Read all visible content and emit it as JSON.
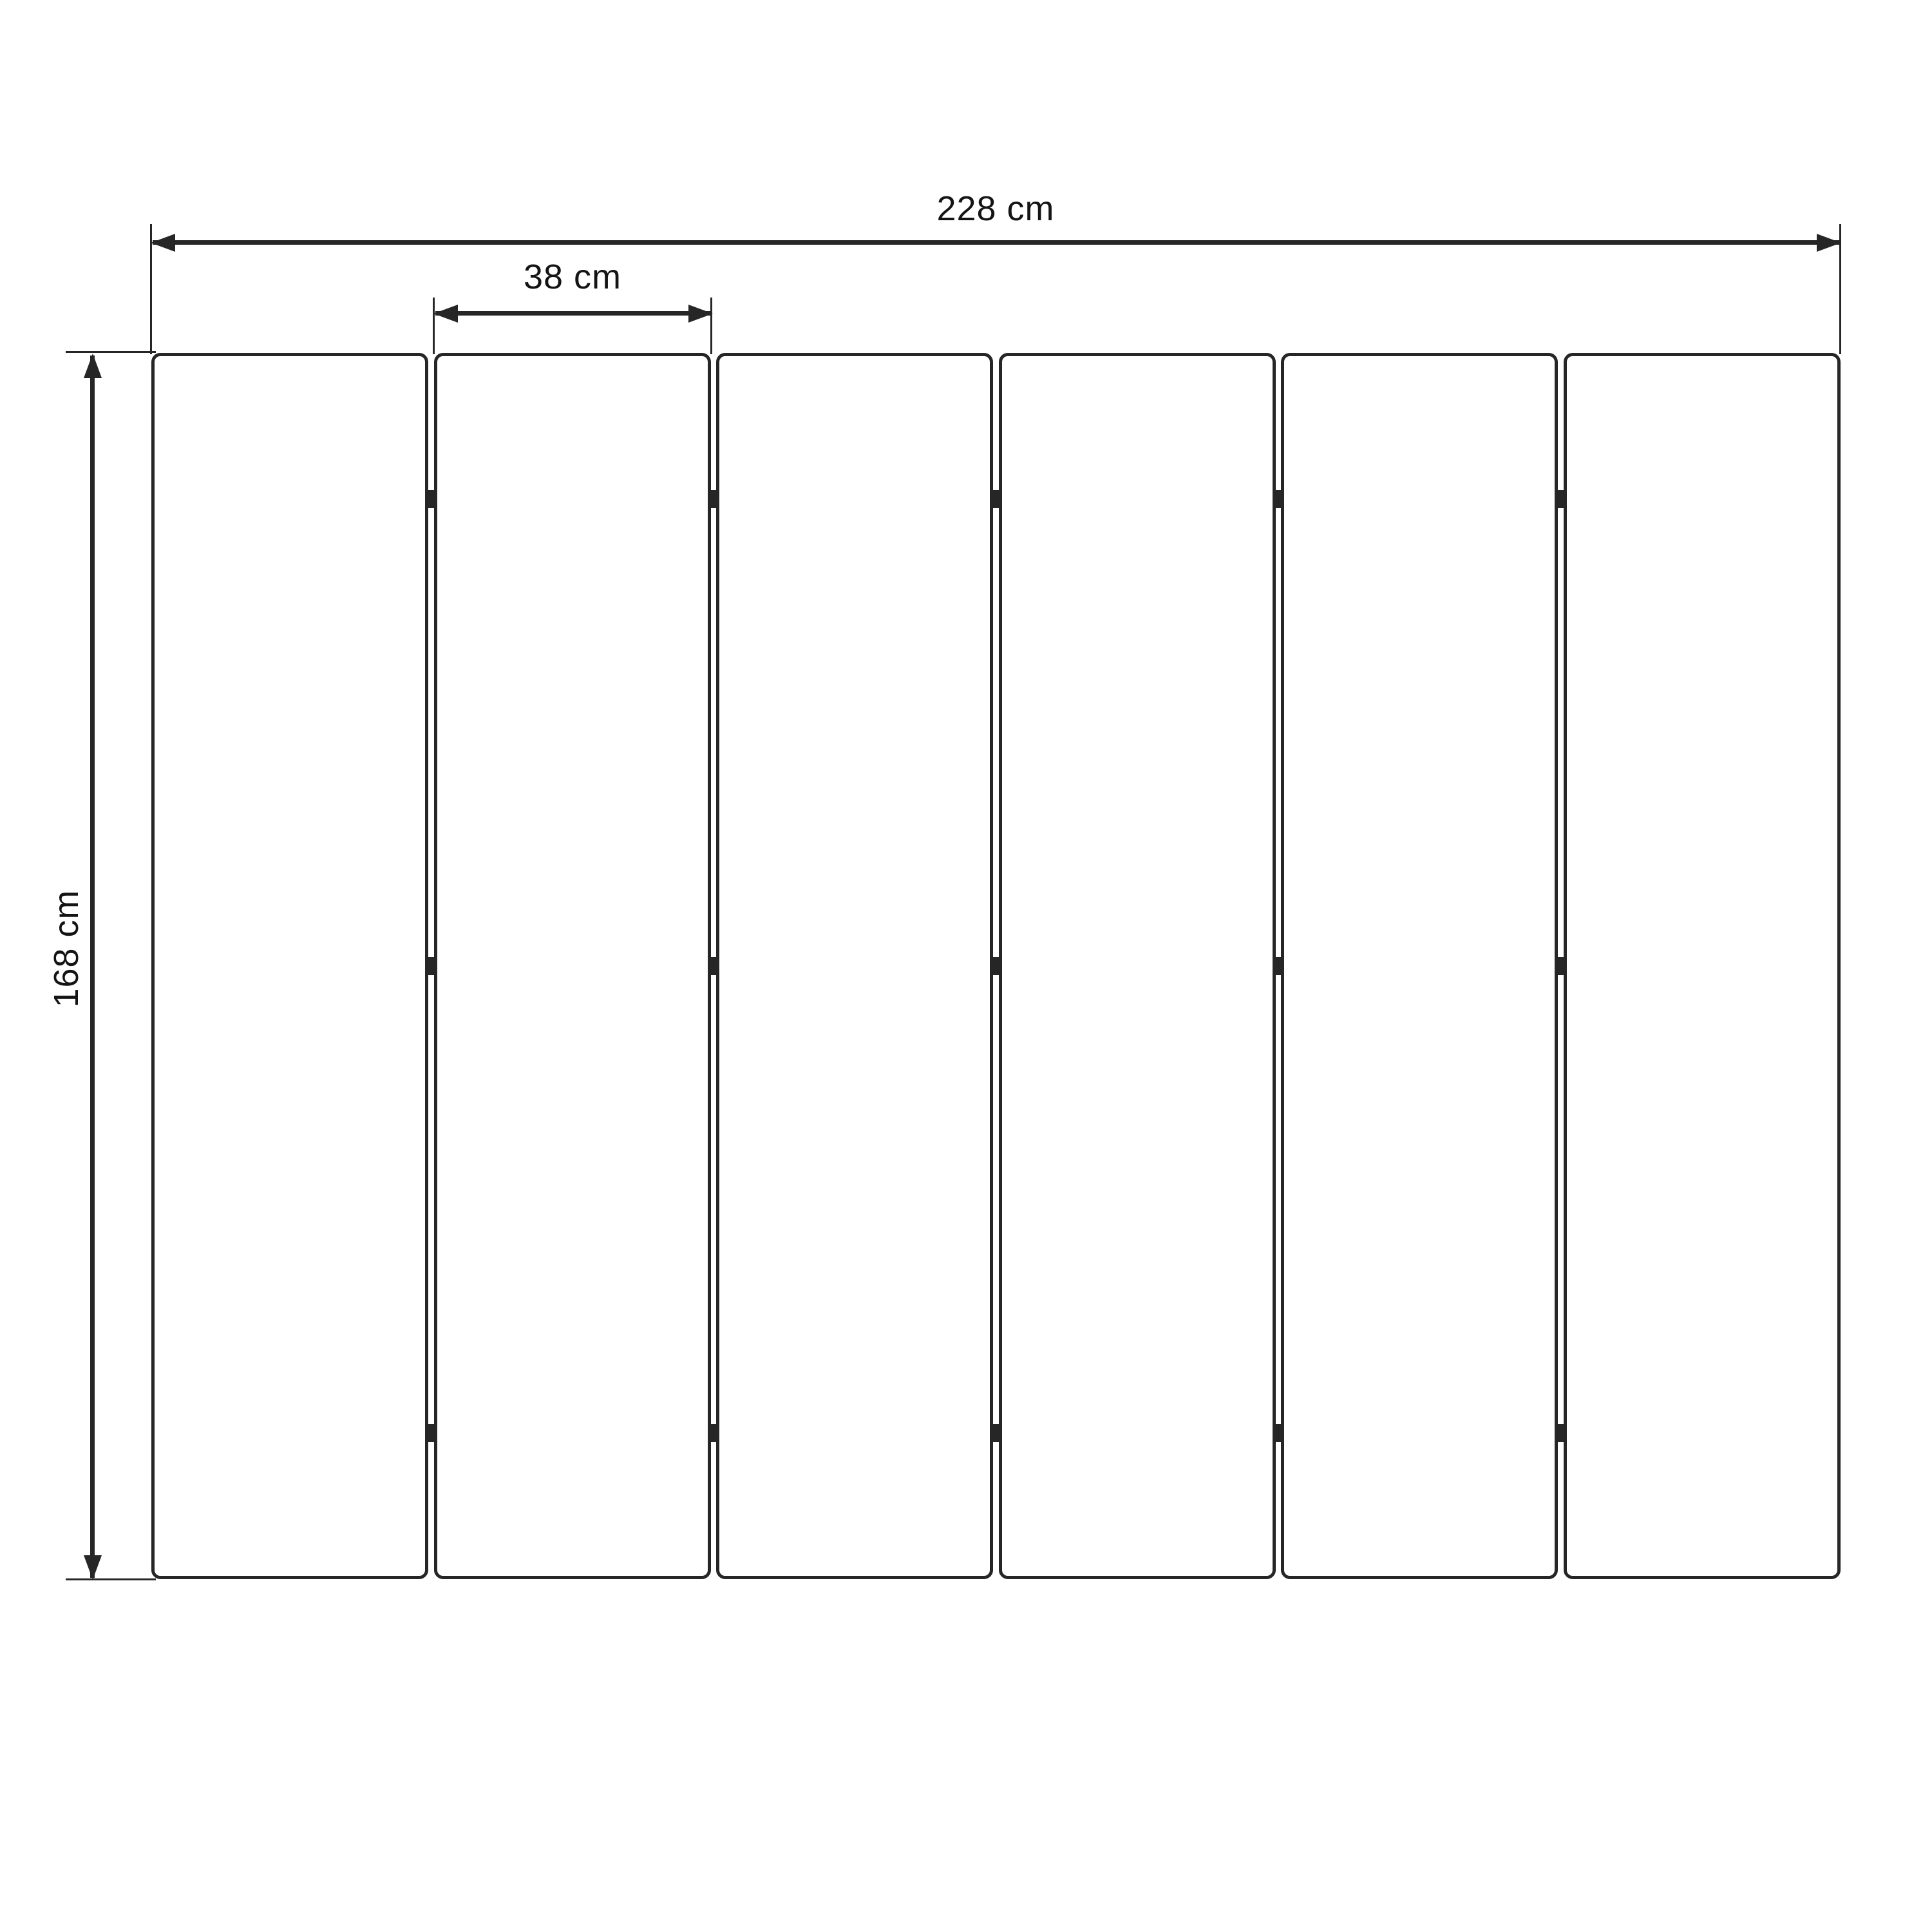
{
  "diagram": {
    "dimensions": {
      "total_width": "228 cm",
      "panel_width": "38 cm",
      "height": "168 cm"
    },
    "panels": {
      "count": 6,
      "joints": 5,
      "hinges_per_joint": 3
    },
    "colors": {
      "line": "#262626",
      "text": "#141414",
      "background": "#ffffff"
    }
  }
}
